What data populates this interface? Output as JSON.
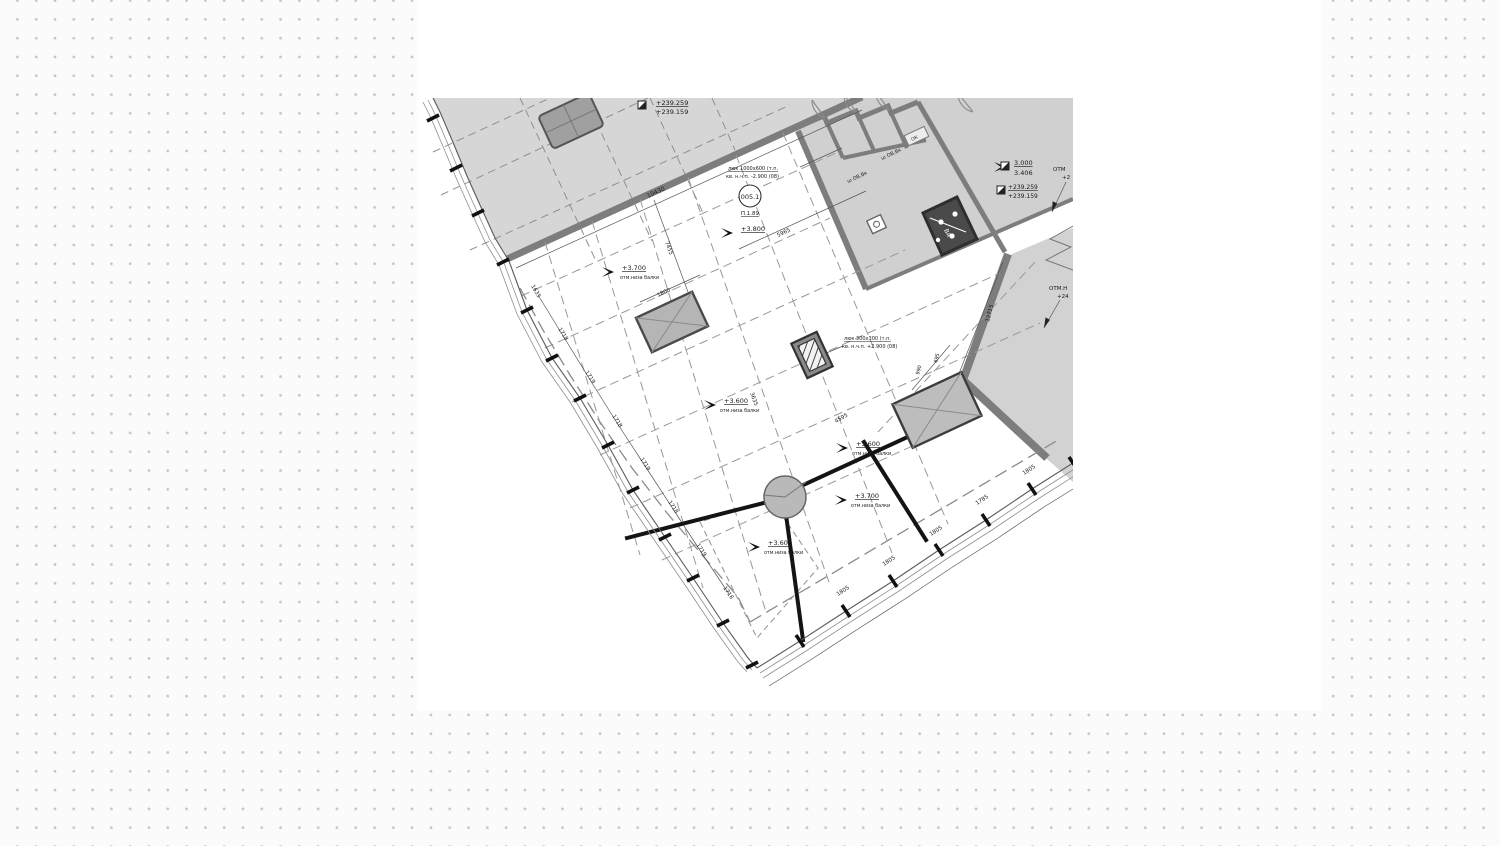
{
  "page": {
    "page_background": "#fbfbfb",
    "dot_color": "#c6c6c6",
    "canvas_color": "#ffffff"
  },
  "drawing": {
    "type": "architectural-floor-plan-fragment",
    "colors": {
      "slab_fill": "#d6d6d6",
      "rooms_fill": "#d0d0d0",
      "wall_stroke": "#7d7d7d",
      "beam_color": "#141414",
      "element_fill": "#b9b9b9",
      "shaft_fill": "#4a4a4a",
      "text_color": "#1a1a1a"
    },
    "labels": [
      {
        "name": "elev-top-left-upper",
        "text": "+239.259",
        "x": 656,
        "y": 105,
        "size": 6.5,
        "ul": true
      },
      {
        "name": "elev-top-left-lower",
        "text": "+239.159",
        "x": 656,
        "y": 114,
        "size": 6.5
      },
      {
        "name": "elev-right-1-upper",
        "text": "3.000",
        "x": 1014,
        "y": 165,
        "size": 6.5,
        "ul": true
      },
      {
        "name": "elev-right-1-lower",
        "text": "3.406",
        "x": 1014,
        "y": 175,
        "size": 6.5
      },
      {
        "name": "elev-right-2-upper",
        "text": "+239.259",
        "x": 1008,
        "y": 189,
        "size": 6,
        "ul": true
      },
      {
        "name": "elev-right-2-lower",
        "text": "+239.159",
        "x": 1008,
        "y": 198,
        "size": 6
      },
      {
        "name": "otm-right-1a",
        "text": "ОТМ",
        "x": 1053,
        "y": 171,
        "size": 5.5
      },
      {
        "name": "otm-right-1b",
        "text": "+2",
        "x": 1062,
        "y": 179,
        "size": 5.5
      },
      {
        "name": "otm-right-2a",
        "text": "ОТМ.Н",
        "x": 1049,
        "y": 290,
        "size": 5.5
      },
      {
        "name": "otm-right-2b",
        "text": "+24",
        "x": 1057,
        "y": 298,
        "size": 5.5
      },
      {
        "name": "room-tag-number",
        "text": "005.1",
        "x": 750,
        "y": 199,
        "size": 6.5,
        "anchor": "middle"
      },
      {
        "name": "room-tag-area",
        "text": "П.1.89",
        "x": 750,
        "y": 215,
        "size": 5.5,
        "anchor": "middle",
        "ul": true
      },
      {
        "name": "hatch-note-1a",
        "text": "люк 1000х600 (т.п.",
        "x": 728,
        "y": 170,
        "size": 5,
        "ul": true
      },
      {
        "name": "hatch-note-1b",
        "text": "кв. н.ч.п. -2.900 (08)",
        "x": 726,
        "y": 178,
        "size": 5
      },
      {
        "name": "hatch-note-2a",
        "text": "люк 300х300 (т.п.",
        "x": 844,
        "y": 340,
        "size": 5,
        "ul": true
      },
      {
        "name": "hatch-note-2b",
        "text": "кв. н.ч.п. +2.900 (08)",
        "x": 842,
        "y": 348,
        "size": 5
      },
      {
        "name": "elev-3800",
        "text": "+3.800",
        "x": 741,
        "y": 231,
        "size": 6.5,
        "ul": true
      },
      {
        "name": "elev-3700-1",
        "text": "+3.700",
        "x": 622,
        "y": 270,
        "size": 6.5,
        "ul": true
      },
      {
        "name": "elev-3700-1-sub",
        "text": "отм.низа балки",
        "x": 620,
        "y": 279,
        "size": 4.8
      },
      {
        "name": "elev-3600-1",
        "text": "+3.600",
        "x": 724,
        "y": 403,
        "size": 6.5,
        "ul": true
      },
      {
        "name": "elev-3600-1-sub",
        "text": "отм.низа балки",
        "x": 720,
        "y": 412,
        "size": 4.8
      },
      {
        "name": "elev-3600-2",
        "text": "+3.600",
        "x": 856,
        "y": 446,
        "size": 6.5,
        "ul": true
      },
      {
        "name": "elev-3600-2-sub",
        "text": "отм.низа балки",
        "x": 852,
        "y": 455,
        "size": 4.8
      },
      {
        "name": "elev-3700-2",
        "text": "+3.700",
        "x": 855,
        "y": 498,
        "size": 6.5,
        "ul": true
      },
      {
        "name": "elev-3700-2-sub",
        "text": "отм.низа балки",
        "x": 851,
        "y": 507,
        "size": 4.8
      },
      {
        "name": "elev-3600-3",
        "text": "+3.600",
        "x": 768,
        "y": 545,
        "size": 6.5,
        "ul": true
      },
      {
        "name": "elev-3600-3-sub",
        "text": "отм.низа балки",
        "x": 764,
        "y": 554,
        "size": 4.8
      },
      {
        "name": "dim-10430",
        "text": "10430",
        "x": 648,
        "y": 198,
        "size": 6,
        "rot": -25
      },
      {
        "name": "dim-5965",
        "text": "5965",
        "x": 778,
        "y": 237,
        "size": 5.5,
        "rot": -25
      },
      {
        "name": "dim-7455",
        "text": "7455",
        "x": 665,
        "y": 242,
        "size": 5.5,
        "rot": 70
      },
      {
        "name": "dim-1800",
        "text": "1800",
        "x": 658,
        "y": 297,
        "size": 5.5,
        "rot": -25
      },
      {
        "name": "dim-1635",
        "text": "1635",
        "x": 531,
        "y": 286,
        "size": 5.5,
        "rot": 60
      },
      {
        "name": "dim-1718-1",
        "text": "1718",
        "x": 558,
        "y": 329,
        "size": 5.5,
        "rot": 58
      },
      {
        "name": "dim-1719-1",
        "text": "1719",
        "x": 585,
        "y": 372,
        "size": 5.5,
        "rot": 58
      },
      {
        "name": "dim-1718-2",
        "text": "1718",
        "x": 612,
        "y": 416,
        "size": 5.5,
        "rot": 58
      },
      {
        "name": "dim-1719-2",
        "text": "1719",
        "x": 640,
        "y": 459,
        "size": 5.5,
        "rot": 58
      },
      {
        "name": "dim-1718-3",
        "text": "1718",
        "x": 668,
        "y": 502,
        "size": 5.5,
        "rot": 57
      },
      {
        "name": "dim-1719-3",
        "text": "1719",
        "x": 696,
        "y": 545,
        "size": 5.5,
        "rot": 56
      },
      {
        "name": "dim-1718-4",
        "text": "1718",
        "x": 723,
        "y": 588,
        "size": 5.5,
        "rot": 55
      },
      {
        "name": "dim-1805-1",
        "text": "1805",
        "x": 838,
        "y": 596,
        "size": 5.5,
        "rot": -33
      },
      {
        "name": "dim-1805-2",
        "text": "1805",
        "x": 884,
        "y": 566,
        "size": 5.5,
        "rot": -33
      },
      {
        "name": "dim-1805-3",
        "text": "1805",
        "x": 931,
        "y": 536,
        "size": 5.5,
        "rot": -33
      },
      {
        "name": "dim-1785",
        "text": "1785",
        "x": 977,
        "y": 505,
        "size": 5.5,
        "rot": -33
      },
      {
        "name": "dim-1805-4",
        "text": "1805",
        "x": 1024,
        "y": 475,
        "size": 5.5,
        "rot": -33
      },
      {
        "name": "dim-4595",
        "text": "4595",
        "x": 836,
        "y": 423,
        "size": 5.5,
        "rot": -30
      },
      {
        "name": "dim-3635",
        "text": "3635",
        "x": 750,
        "y": 393,
        "size": 5.5,
        "rot": 70
      },
      {
        "name": "dim-990",
        "text": "990",
        "x": 919,
        "y": 375,
        "size": 5,
        "rot": -75
      },
      {
        "name": "dim-695",
        "text": "695",
        "x": 937,
        "y": 363,
        "size": 5,
        "rot": -75
      },
      {
        "name": "dim-12715",
        "text": "12715",
        "x": 989,
        "y": 322,
        "size": 5.5,
        "rot": -76
      },
      {
        "name": "room-label-shaft-1",
        "text": "ш ОВ,Вк",
        "x": 848,
        "y": 183,
        "size": 5,
        "rot": -25
      },
      {
        "name": "room-label-shaft-2",
        "text": "ш ОВ,Вк",
        "x": 882,
        "y": 160,
        "size": 5,
        "rot": -25
      },
      {
        "name": "room-label-ok",
        "text": "ОК",
        "x": 912,
        "y": 141,
        "size": 4.5,
        "rot": -25
      },
      {
        "name": "shaft-va-label",
        "text": "ВА",
        "x": 944,
        "y": 230,
        "size": 6,
        "rot": 65,
        "color": "#ffffff"
      }
    ],
    "flags": [
      {
        "x": 733,
        "y": 233
      },
      {
        "x": 614,
        "y": 272
      },
      {
        "x": 716,
        "y": 405
      },
      {
        "x": 848,
        "y": 448
      },
      {
        "x": 847,
        "y": 500
      },
      {
        "x": 760,
        "y": 547
      },
      {
        "x": 1006,
        "y": 167
      }
    ],
    "level_marks": [
      {
        "x": 638,
        "y": 101
      },
      {
        "x": 1001,
        "y": 162
      },
      {
        "x": 997,
        "y": 186
      }
    ]
  }
}
